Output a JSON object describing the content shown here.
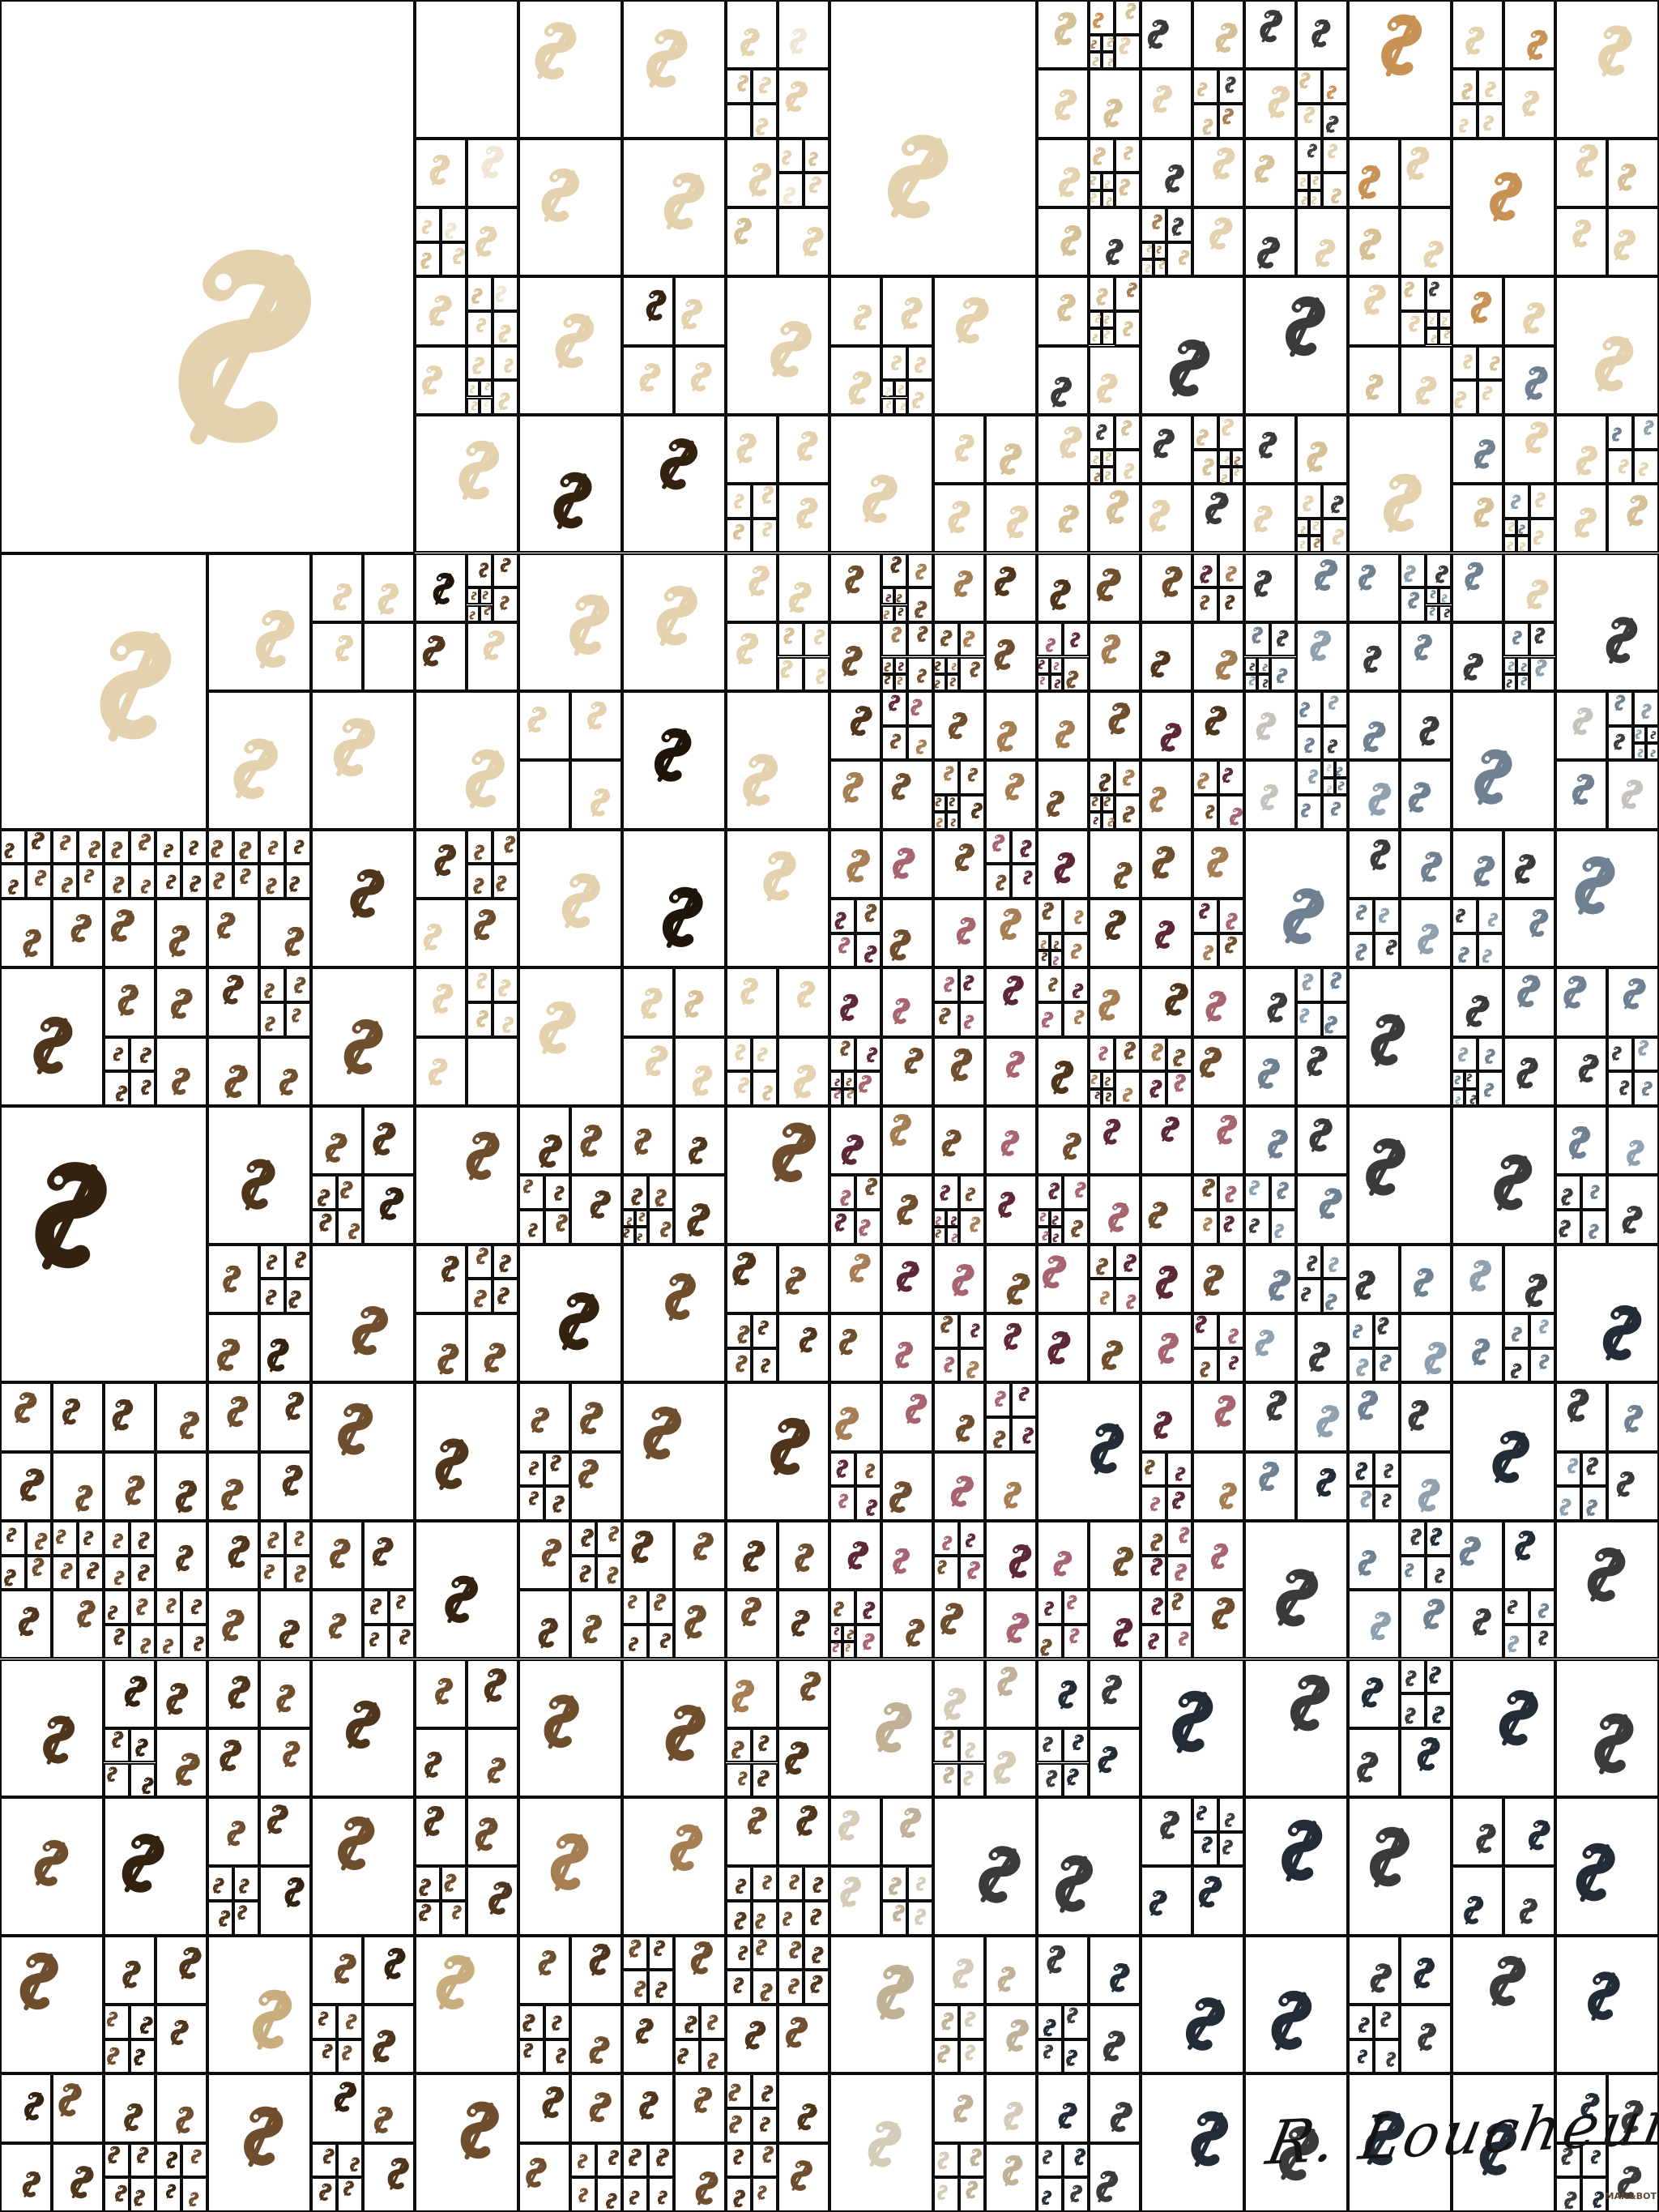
{
  "artwork": {
    "glyph": "dollar-sign",
    "signature": "R. Loucheur",
    "watermark": "MAN&BOT",
    "background_color": "#ffffff",
    "grid_line_color": "#0d0d0d",
    "palette": {
      "0": "#EFE6D3",
      "1": "#E3D2AD",
      "2": "#D6C196",
      "3": "#C8AE7E",
      "4": "#C89254",
      "5": "#A67E53",
      "6": "#8A6436",
      "7": "#6E4E2D",
      "8": "#4E351C",
      "9": "#32220F",
      "a": "#1F1409",
      "b": "#3B393B",
      "c": "#6F8191",
      "d": "#8FA0AF",
      "e": "#5C2835",
      "f": "#A5646F",
      "g": "#BFB096",
      "h": "#D4CBB8",
      "i": "#C7C3BC",
      "j": "#232C36"
    },
    "cells": {
      "00": "1",
      "10": "((.1(10(1021)1)1)(1(10(21.1)1)1(1(1201)21))((1(2011)1(11(1210)1))119)((9111)19(11(1121)1)))",
      "20": "(1((2(42(5222)1)12)(b21(2b25))(1(22(2112)2)2b)(b1(5b(2512)2)1))((111(11(0111)1))11(1211))((2(25(1221)2)b1)b(1(b2(2252)1)22)(b(212(1522))1b)))",
      "30": "(((bb1(241b))4(2(b1(1221)2)b1)(4121))((14(2111)1)14(1211))(b(1(2b1(1122))21)(b21(1b(2115)1))1)((41(1211)c)1(c12(d1(1c11)1))(1(cd11)12)))",
      "01": "(1(1(111.)11)(((8887)(7777)77)((7777)(8888)77)8(77(8888)7))(((7777)(7878)77)8(8(7777)77)7))",
      "11": "(((a(88(7777)7)81)11(11.1))(1(111(2111))a1)((8(7777)17)1(1(1121)1.)1)(a1(1211)(11(1112)1)))",
      "21": "(((7(85(e758)7)7(57(7e85)7))(58(75(8577)7)7)(8(ef75)57)(75(57(7857)8)5))((87(fe(effe)7)5)(7(e578)85)(577(85(77e5)7))(e85(5e7f)))((5f(e7fe)7)(7(fe7e)f5)(ef(7e(e7f5)f)7)((fe7f)e7f))((e7(75(578f)5)8)(75e(ef57))((7ef5)58(f7(57e8)5))(8f(57ef)7)))",
      "31": "(((bc(cb(bcdb)c)d)(c(dbc(cdcb))bc)(i(cdcb)i(d(icic)cc))(cbdc))((c1b(cb(dcbc)d))bc(i(cdb(dbdc))ci))(c(bc(cdcb)d)(b(dcdc)cb)b)((cb(bdcd)c)c(bc(dc(cbdb)c)b)(ccb(bdbc))))",
      "02": "(9(8(78(8787)9)(7(8888)79)7)((7887)(8778)((8787)(7878)87)((7878)8(8787)(7878)))((7878)7(8(7777)78)(787(8888))))",
      "12": "((7(87(7887)8)(8(7878)77)9)((78(87(7788)7)8)77(87(7878)8))(8(77(8888)7)9(7(8787)87))(78(87(7788)7)(8778)))",
      "03": "((8(98(8989)7)79)((8787)8(78(8888)9)7)(7(88(7979)8)(9788)(87(8888)(9797)))(3(79(8787)8)7(97(8888)8)))",
      "13": "(((7887)7(87(8787)8)5)(7(57(7878)8)5(78(8787)(7878)))(3(78(8888)7)7(877(7878)))(((7878)78(8787))((8787)(7878)87)(87(8888)7)((7878)8(8787)7)))",
      "22": "(((e5(f7ef)7)(7f(e7(fe7f)5)e)(5e7f)(f7(7ef5)e))((7e(ef(fefe)7)f)(ef7(7f5e))(f(7e5f)e7)(e7f(ef7e)))((5f(e7fe)7)(7(fe7e)f5)(ef(7e(e7f5)f)7)((fe7f)e7f))(j(ef(7efe)5)(f7(ef7f)e)((7fef)f(e7ef)7)))",
      "32": "(((cb(dcbd)c)b(c(bdbc)db)(bc(cbdc)d))(b(cd(bcbc)b)(dbc(cdbc))j)((bdcj)(cb(jbdb)d)b(c(bjcb)dc))(j(bc(dbdc)b)(cjb(bcdb))b))",
      "23": "((g(hg(ghgh)h)(hgh(ghgh))b)((jb(bjbj)j)jb(b(jbjb)jj))(g(hg(ghgh)g)h(gh(hghg)g))((bj(jbbj)b)j(jb(bjjb)b)j))",
      "33": "((b(j(bjbj)bj)jb)(jb(bjjb)j)(j(bj(jbjb)b)bj)(bjj(jb(bjbj)b)))"
    }
  }
}
